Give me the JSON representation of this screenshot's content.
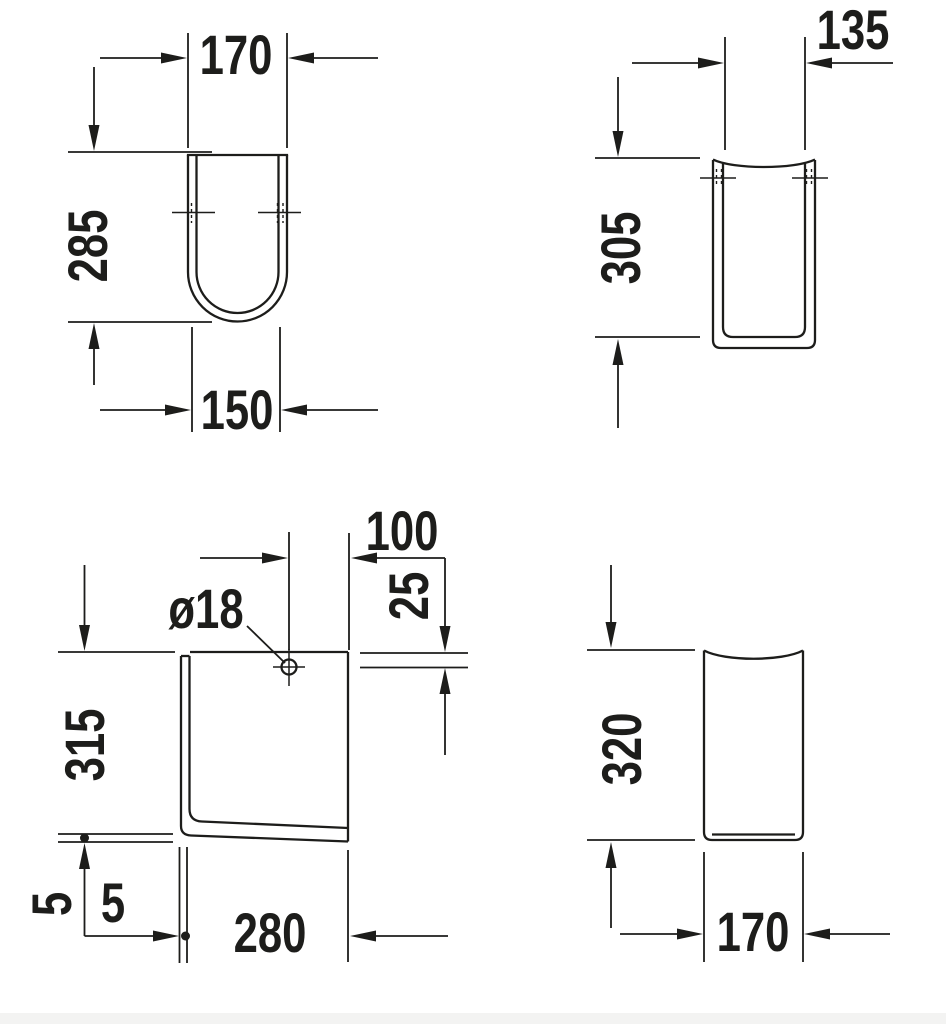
{
  "colors": {
    "background": "#ffffff",
    "line": "#1d1d1b"
  },
  "views": {
    "top_left": {
      "width_top": "170",
      "height": "285",
      "width_bottom": "150"
    },
    "top_right": {
      "width_top": "135",
      "height": "305"
    },
    "bottom_left": {
      "hole_offset": "100",
      "hole_diameter": "ø18",
      "hole_depth": "25",
      "height": "315",
      "gap_vertical": "5",
      "gap_horizontal": "5",
      "depth": "280"
    },
    "bottom_right": {
      "height": "320",
      "width": "170"
    }
  }
}
